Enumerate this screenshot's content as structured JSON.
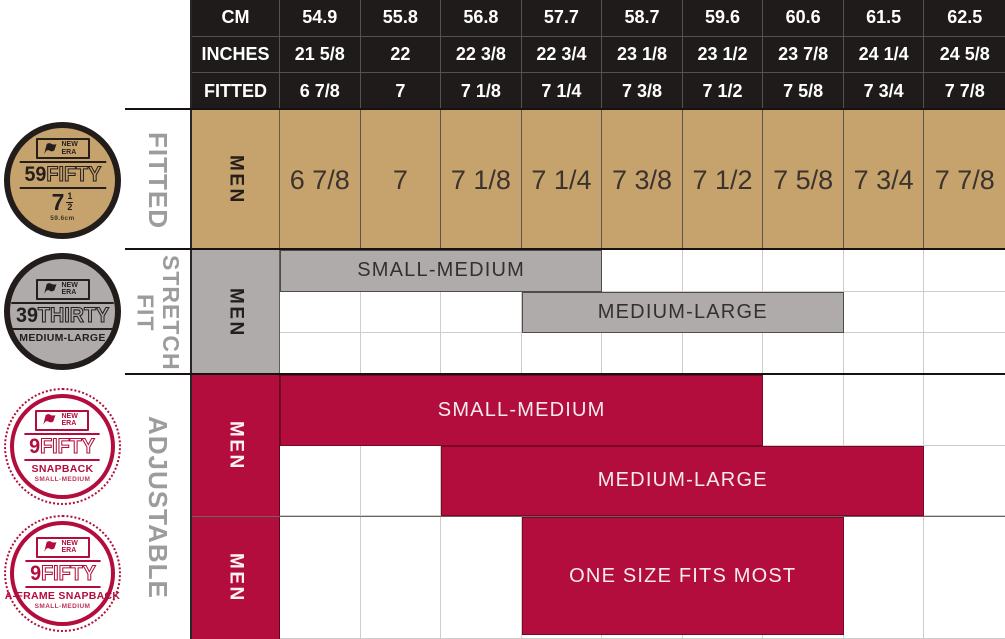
{
  "colors": {
    "header_bg": "#1f1b1a",
    "tan": "#c6a26c",
    "gray": "#afabaa",
    "red": "#b20d3c",
    "label_gray": "#9c9c9c",
    "white": "#ffffff"
  },
  "chart_data": {
    "type": "table",
    "title": "New Era cap size chart",
    "columns_cm": [
      54.9,
      55.8,
      56.8,
      57.7,
      58.7,
      59.6,
      60.6,
      61.5,
      62.5
    ],
    "columns_inches": [
      "21 5/8",
      "22",
      "22 3/8",
      "22 3/4",
      "23 1/8",
      "23 1/2",
      "23 7/8",
      "24 1/4",
      "24 5/8"
    ],
    "columns_fitted": [
      "6 7/8",
      "7",
      "7 1/8",
      "7 1/4",
      "7 3/8",
      "7 1/2",
      "7 5/8",
      "7 3/4",
      "7 7/8"
    ],
    "rows": [
      {
        "section": "FITTED",
        "product": "59FIFTY",
        "gender": "MEN",
        "coverage": "6 7/8 through 7 7/8"
      },
      {
        "section": "STRETCH FIT",
        "product": "39THIRTY",
        "gender": "MEN",
        "ranges": [
          {
            "label": "SMALL-MEDIUM",
            "from": "6 7/8",
            "to": "7 1/4"
          },
          {
            "label": "MEDIUM-LARGE",
            "from": "7 1/4",
            "to": "7 5/8"
          }
        ]
      },
      {
        "section": "ADJUSTABLE",
        "product": "9FIFTY SNAPBACK",
        "gender": "MEN",
        "ranges": [
          {
            "label": "SMALL-MEDIUM",
            "from": "6 7/8",
            "to": "7 1/2"
          },
          {
            "label": "MEDIUM-LARGE",
            "from": "7 1/8",
            "to": "7 3/4"
          }
        ]
      },
      {
        "section": "ADJUSTABLE",
        "product": "9FIFTY A-FRAME SNAPBACK",
        "gender": "MEN",
        "ranges": [
          {
            "label": "ONE SIZE FITS MOST",
            "from": "7 1/4",
            "to": "7 5/8"
          }
        ]
      }
    ]
  },
  "table": {
    "side_labels": [
      "FITTED",
      "STRETCH FIT",
      "ADJUSTABLE"
    ],
    "header_rows": [
      {
        "label": "CM",
        "values": [
          "54.9",
          "55.8",
          "56.8",
          "57.7",
          "58.7",
          "59.6",
          "60.6",
          "61.5",
          "62.5"
        ]
      },
      {
        "label": "INCHES",
        "values": [
          "21 5/8",
          "22",
          "22 3/8",
          "22 3/4",
          "23 1/8",
          "23 1/2",
          "23 7/8",
          "24 1/4",
          "24 5/8"
        ]
      },
      {
        "label": "FITTED",
        "values": [
          "6 7/8",
          "7",
          "7 1/8",
          "7 1/4",
          "7 3/8",
          "7 1/2",
          "7 5/8",
          "7 3/4",
          "7 7/8"
        ]
      }
    ],
    "sections": [
      {
        "id": "fitted",
        "type": "values",
        "men": "MEN",
        "values": [
          "6 7/8",
          "7",
          "7 1/8",
          "7 1/4",
          "7 3/8",
          "7 1/2",
          "7 5/8",
          "7 3/4",
          "7 7/8"
        ]
      },
      {
        "id": "stretch",
        "type": "bars",
        "men": "MEN",
        "rows": 3,
        "bars": [
          {
            "row": 1,
            "start": 0,
            "span": 4,
            "label": "SMALL-MEDIUM"
          },
          {
            "row": 2,
            "start": 3,
            "span": 4,
            "label": "MEDIUM-LARGE"
          }
        ]
      },
      {
        "id": "snapback",
        "type": "bars",
        "men": "MEN",
        "rows": 2,
        "bars": [
          {
            "row": 1,
            "start": 0,
            "span": 6,
            "label": "SMALL-MEDIUM"
          },
          {
            "row": 2,
            "start": 2,
            "span": 6,
            "label": "MEDIUM-LARGE"
          }
        ]
      },
      {
        "id": "aframe",
        "type": "bars",
        "men": "MEN",
        "rows": 1,
        "bars": [
          {
            "row": 1,
            "start": 3,
            "span": 4,
            "label": "ONE SIZE FITS MOST"
          }
        ]
      }
    ]
  },
  "badges": [
    {
      "id": "59fifty",
      "theme": "tan",
      "brand": "NEW ERA",
      "number": "59",
      "word": "FIFTY",
      "size_main": "7",
      "fraction_top": "1",
      "fraction_bottom": "2",
      "fine_print": "59.6cm"
    },
    {
      "id": "39thirty",
      "theme": "gray",
      "brand": "NEW ERA",
      "number": "39",
      "word": "THIRTY",
      "subtitle": "MEDIUM-LARGE"
    },
    {
      "id": "9fifty-snapback",
      "theme": "red",
      "brand": "NEW ERA",
      "number": "9",
      "word": "FIFTY",
      "subtitle": "SNAPBACK",
      "fine_print": "SMALL-MEDIUM"
    },
    {
      "id": "9fifty-aframe",
      "theme": "red",
      "brand": "NEW ERA",
      "number": "9",
      "word": "FIFTY",
      "subtitle": "A-FRAME SNAPBACK",
      "fine_print": "SMALL-MEDIUM"
    }
  ]
}
